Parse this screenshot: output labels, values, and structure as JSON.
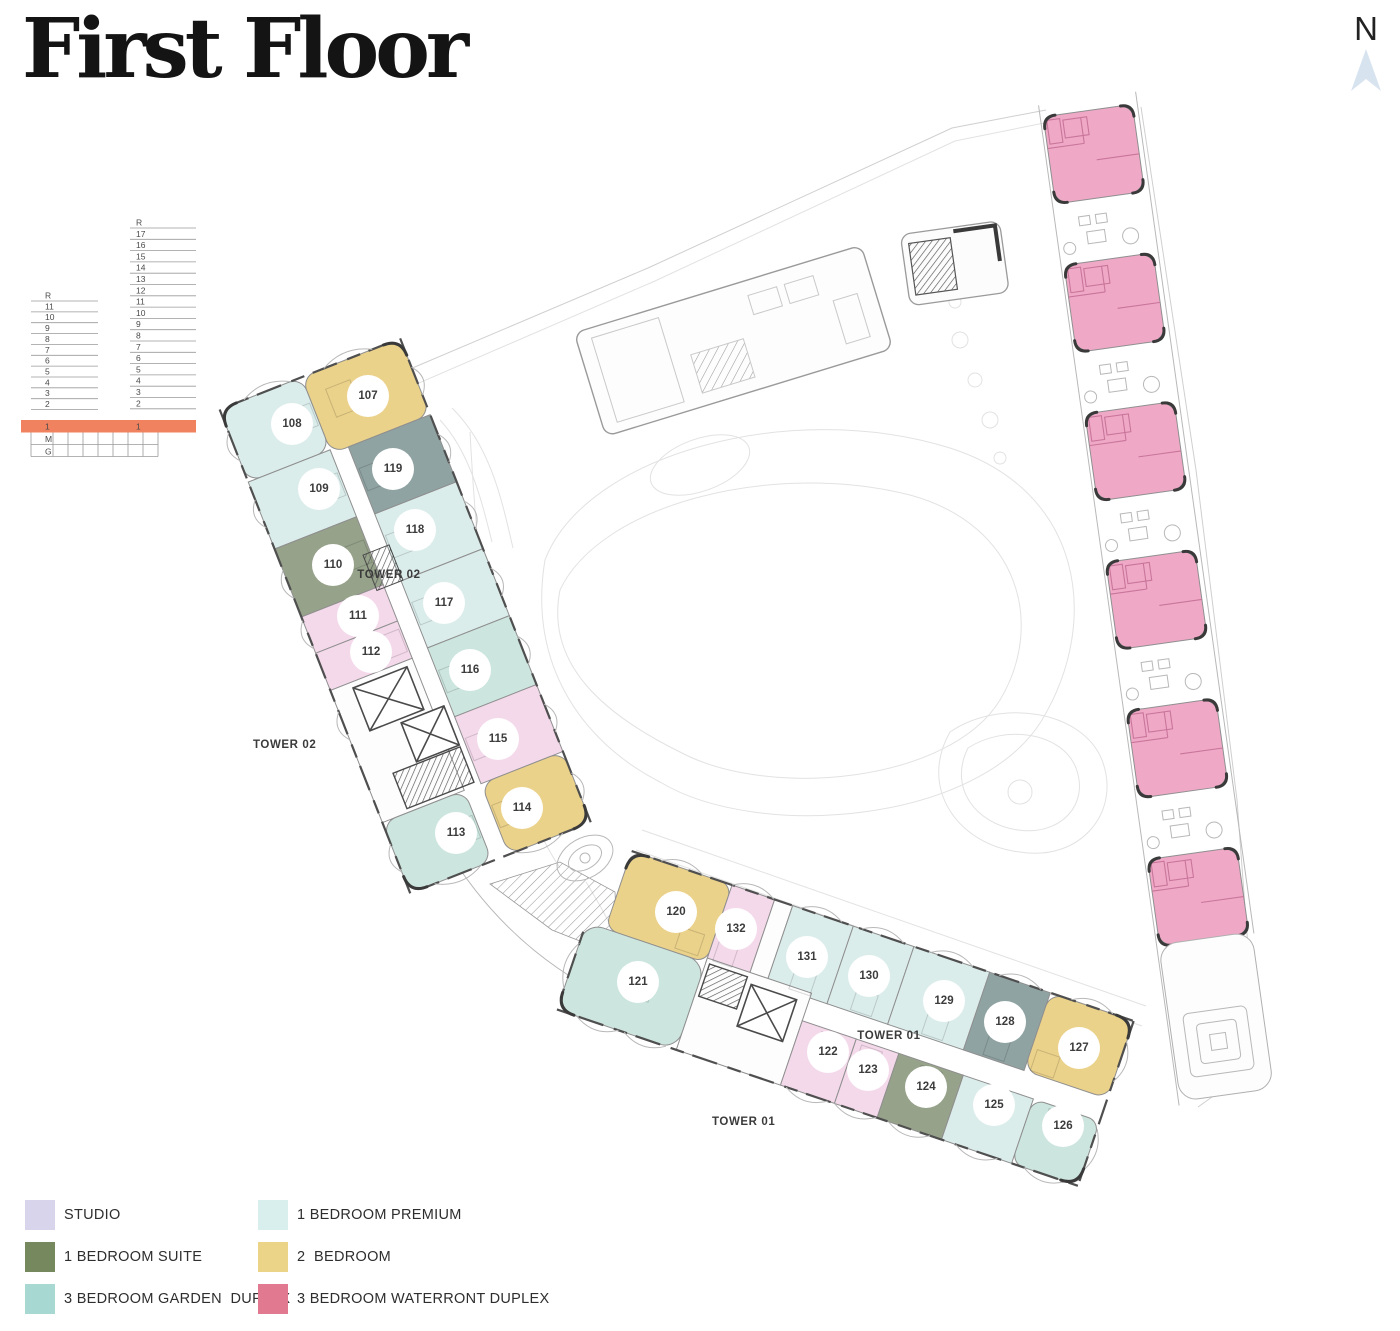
{
  "title": "First Floor",
  "compass": {
    "label": "N"
  },
  "level_diagram": {
    "tall_tower_floors": [
      "R",
      "17",
      "16",
      "15",
      "14",
      "13",
      "12",
      "11",
      "10",
      "9",
      "8",
      "7",
      "6",
      "5",
      "4",
      "3",
      "2"
    ],
    "short_tower_floors": [
      "R",
      "11",
      "10",
      "9",
      "8",
      "7",
      "6",
      "5",
      "4",
      "3",
      "2"
    ],
    "highlighted_floor": "1",
    "podium_levels": [
      "M",
      "G"
    ],
    "highlight_color": "#F0825F"
  },
  "legend": {
    "columns": [
      [
        {
          "label": "STUDIO",
          "color": "#D8D4EC"
        },
        {
          "label": "1 BEDROOM SUITE",
          "color": "#76885E"
        },
        {
          "label": "3 BEDROOM GARDEN  DUPLEX",
          "color": "#A7D9D2"
        }
      ],
      [
        {
          "label": "1 BEDROOM PREMIUM",
          "color": "#D9EFEE"
        },
        {
          "label": "2  BEDROOM",
          "color": "#EBD388"
        },
        {
          "label": "3 BEDROOM WATERRONT DUPLEX",
          "color": "#E17A90"
        }
      ]
    ]
  },
  "plan": {
    "unit_colors": {
      "studio": "#F4D9EB",
      "premium": "#DBEDEB",
      "suite": "#96A28A",
      "suite_gray": "#90A3A3",
      "two_bed": "#EBD28A",
      "garden": "#CDE5DF",
      "waterfront": "#EFA9C7"
    },
    "tower02": {
      "outer_label": "TOWER 02",
      "inner_label": "TOWER 02",
      "units": [
        {
          "number": "107",
          "type": "2 BEDROOM"
        },
        {
          "number": "108",
          "type": "1 BEDROOM PREMIUM"
        },
        {
          "number": "119",
          "type": "1 BEDROOM SUITE"
        },
        {
          "number": "109",
          "type": "1 BEDROOM PREMIUM"
        },
        {
          "number": "118",
          "type": "1 BEDROOM PREMIUM"
        },
        {
          "number": "110",
          "type": "1 BEDROOM SUITE"
        },
        {
          "number": "117",
          "type": "1 BEDROOM PREMIUM"
        },
        {
          "number": "111",
          "type": "STUDIO"
        },
        {
          "number": "112",
          "type": "STUDIO"
        },
        {
          "number": "116",
          "type": "3 BEDROOM GARDEN DUPLEX"
        },
        {
          "number": "115",
          "type": "STUDIO"
        },
        {
          "number": "114",
          "type": "2 BEDROOM"
        },
        {
          "number": "113",
          "type": "3 BEDROOM GARDEN DUPLEX"
        }
      ]
    },
    "tower01": {
      "outer_label": "TOWER 01",
      "inner_label": "TOWER 01",
      "units": [
        {
          "number": "120",
          "type": "2 BEDROOM"
        },
        {
          "number": "132",
          "type": "STUDIO"
        },
        {
          "number": "121",
          "type": "3 BEDROOM GARDEN DUPLEX"
        },
        {
          "number": "131",
          "type": "1 BEDROOM PREMIUM"
        },
        {
          "number": "130",
          "type": "1 BEDROOM PREMIUM"
        },
        {
          "number": "129",
          "type": "1 BEDROOM PREMIUM"
        },
        {
          "number": "128",
          "type": "1 BEDROOM SUITE"
        },
        {
          "number": "127",
          "type": "2 BEDROOM"
        },
        {
          "number": "122",
          "type": "STUDIO"
        },
        {
          "number": "123",
          "type": "STUDIO"
        },
        {
          "number": "124",
          "type": "1 BEDROOM SUITE"
        },
        {
          "number": "125",
          "type": "1 BEDROOM PREMIUM"
        },
        {
          "number": "126",
          "type": "3 BEDROOM GARDEN DUPLEX"
        }
      ]
    },
    "waterfront_strip": {
      "units_visible": 6,
      "type": "3 BEDROOM WATERRONT DUPLEX"
    }
  }
}
